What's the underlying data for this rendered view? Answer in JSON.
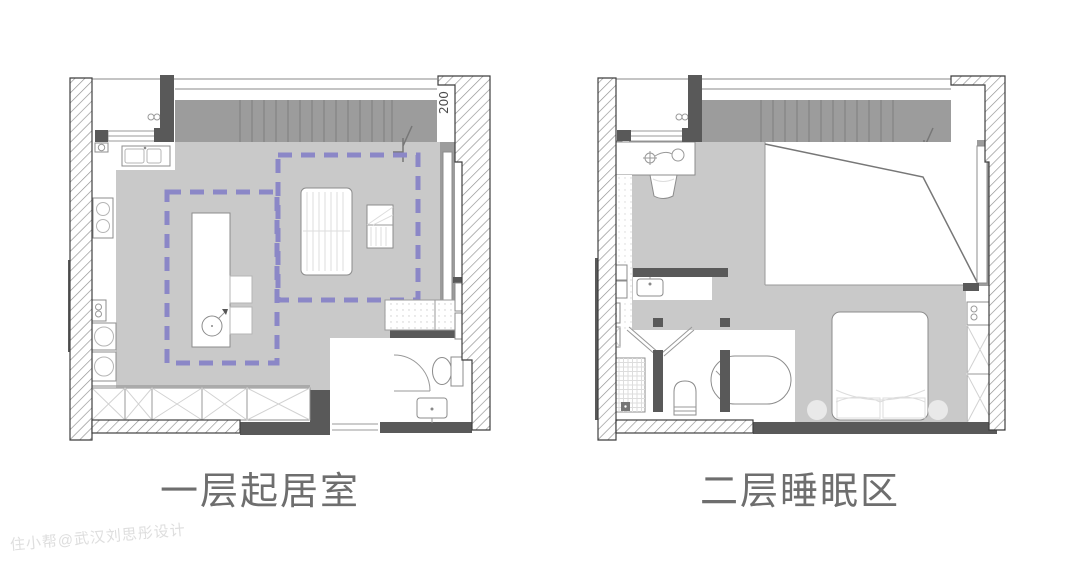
{
  "page": {
    "background": "#ffffff"
  },
  "plans": [
    {
      "id": "level-1",
      "label": "一层起居室",
      "dimension_note": "200"
    },
    {
      "id": "level-2",
      "label": "二层睡眠区"
    }
  ],
  "watermark": "住小帮@武汉刘思彤设计",
  "palette": {
    "floor": "#c9c9c9",
    "stair": "#9c9c9c",
    "wall_dark": "#595959",
    "hatch_line": "#8f8f8f",
    "outline": "#3f3f3f",
    "loft_outline": "#8b87c7",
    "label_text": "#6e6e6e",
    "watermark_text": "#dedede",
    "furniture_stroke": "#8c8c8c"
  }
}
